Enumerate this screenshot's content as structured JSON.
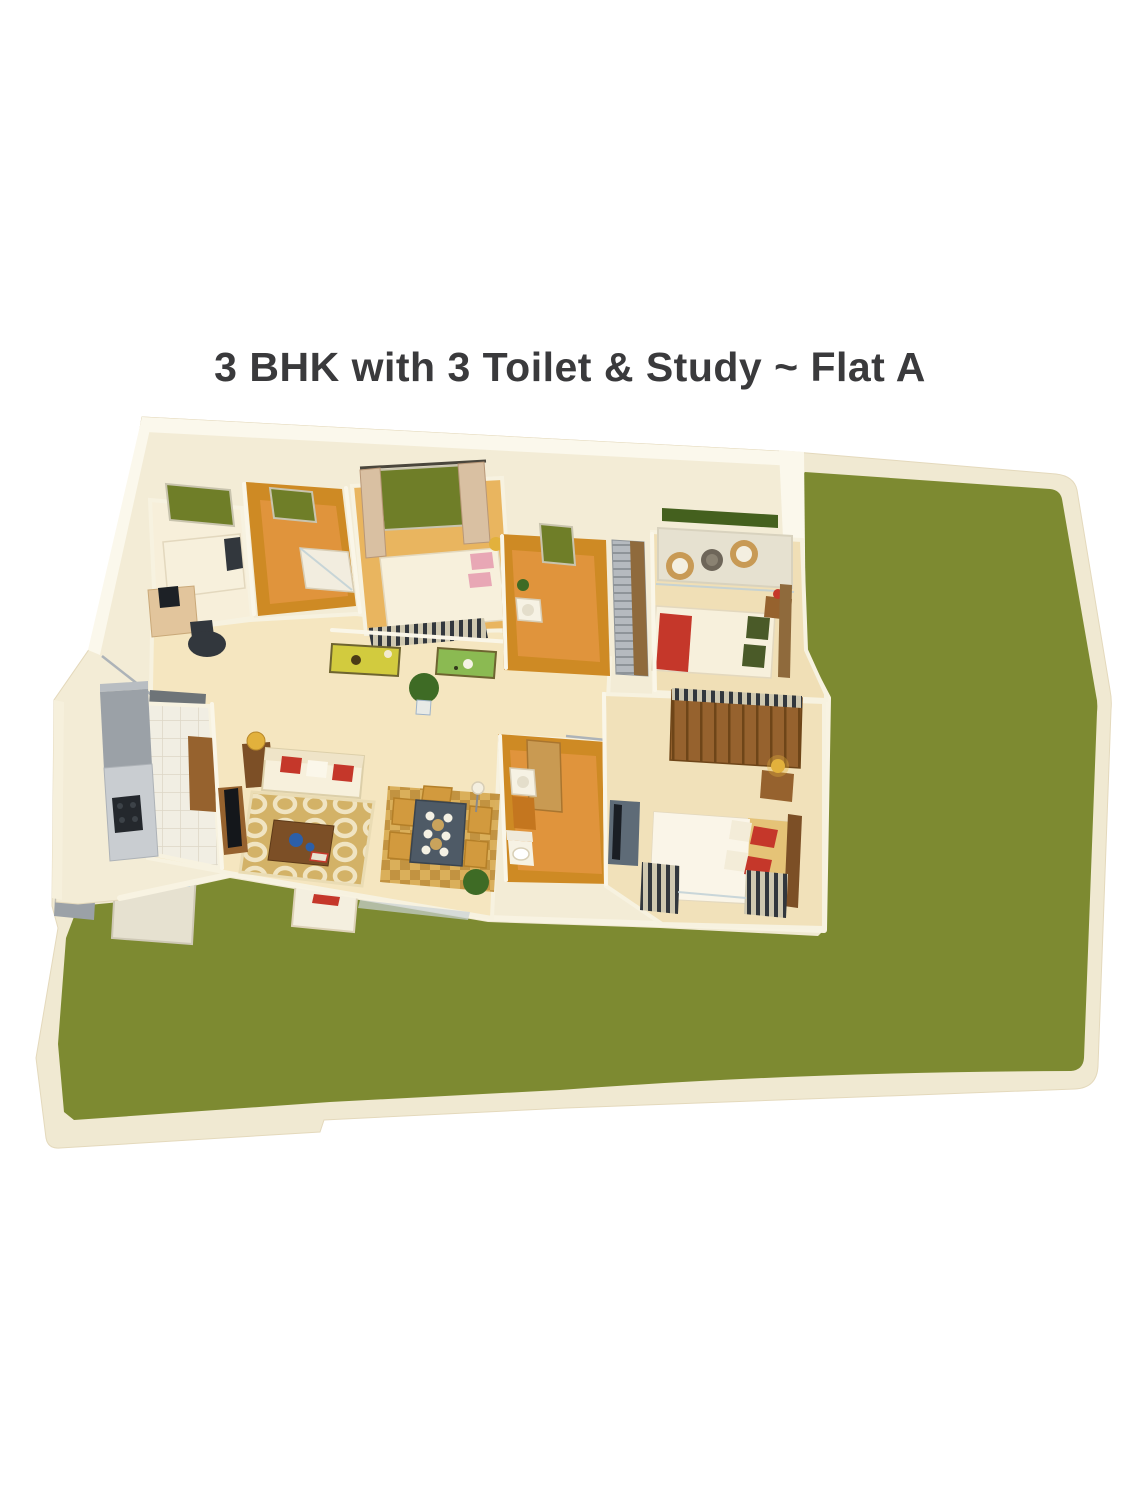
{
  "title": "3 BHK with 3 Toilet & Study ~ Flat A",
  "title_color": "#3A3A3C",
  "colors": {
    "lawn_green": "#7D8A31",
    "platform_cream": "#F0E9D2",
    "apartment_cream": "#F3ECD6",
    "wall_white": "#FBF8EC",
    "hall_floor": "#F5E6C0",
    "pale_floor": "#F7EFDA",
    "master_floor": "#E9B55F",
    "bedroom2_floor": "#F0DFB6",
    "bedroom3_floor": "#F1E1BA",
    "tile_wall_orange": "#CE8A24",
    "tile_floor_orange": "#E0943C",
    "window_green": "#6F7E28",
    "hedge_green": "#44601E",
    "accent_red": "#C5372A",
    "pink_accent": "#E8A7B5",
    "rug_tan": "#D3B267",
    "rug_pattern_cream": "#F0E4C2",
    "dining_rug": "#D7A94F",
    "dining_rug_dark": "#BC8A33",
    "wood_brown": "#96622E",
    "wood_dark": "#7C4F26",
    "wood_light": "#C99A52",
    "slate_dark": "#32373D",
    "appliance_gray": "#9BA1A7",
    "granite_gray": "#C9CDD1",
    "balcony_gray": "#E6E1D0",
    "gold": "#E2B13C",
    "cream_furniture": "#F7F0DC",
    "blue_decor": "#2C5FA8",
    "tv_cabinet": "#5E6B77",
    "plant_green": "#3E6B25",
    "table_top": "#4E5A66",
    "chair_amber": "#D29A3E",
    "glass_blue": "#BFD0D6",
    "rattan": "#C89A55"
  }
}
